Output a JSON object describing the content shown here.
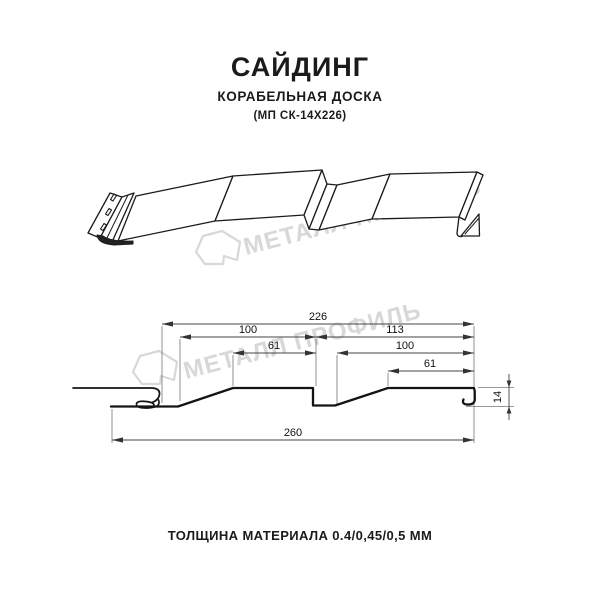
{
  "header": {
    "title": "САЙДИНГ",
    "subtitle": "КОРАБЕЛЬНАЯ ДОСКА",
    "model": "(МП СК-14Х226)"
  },
  "watermark": {
    "text": "МЕТАЛЛ ПРОФИЛЬ",
    "color": "#d8d8d8"
  },
  "cross_section": {
    "dimensions": [
      {
        "name": "overall-profile-width",
        "value": "226"
      },
      {
        "name": "board-1-width",
        "value": "100"
      },
      {
        "name": "board-2-span",
        "value": "113"
      },
      {
        "name": "board-1-flat",
        "value": "61"
      },
      {
        "name": "board-2-width",
        "value": "100"
      },
      {
        "name": "board-2-flat",
        "value": "61"
      },
      {
        "name": "total-width",
        "value": "260"
      },
      {
        "name": "profile-depth",
        "value": "14"
      }
    ]
  },
  "footer": {
    "thickness_label": "ТОЛЩИНА МАТЕРИАЛА 0.4/0,45/0,5 ММ"
  }
}
